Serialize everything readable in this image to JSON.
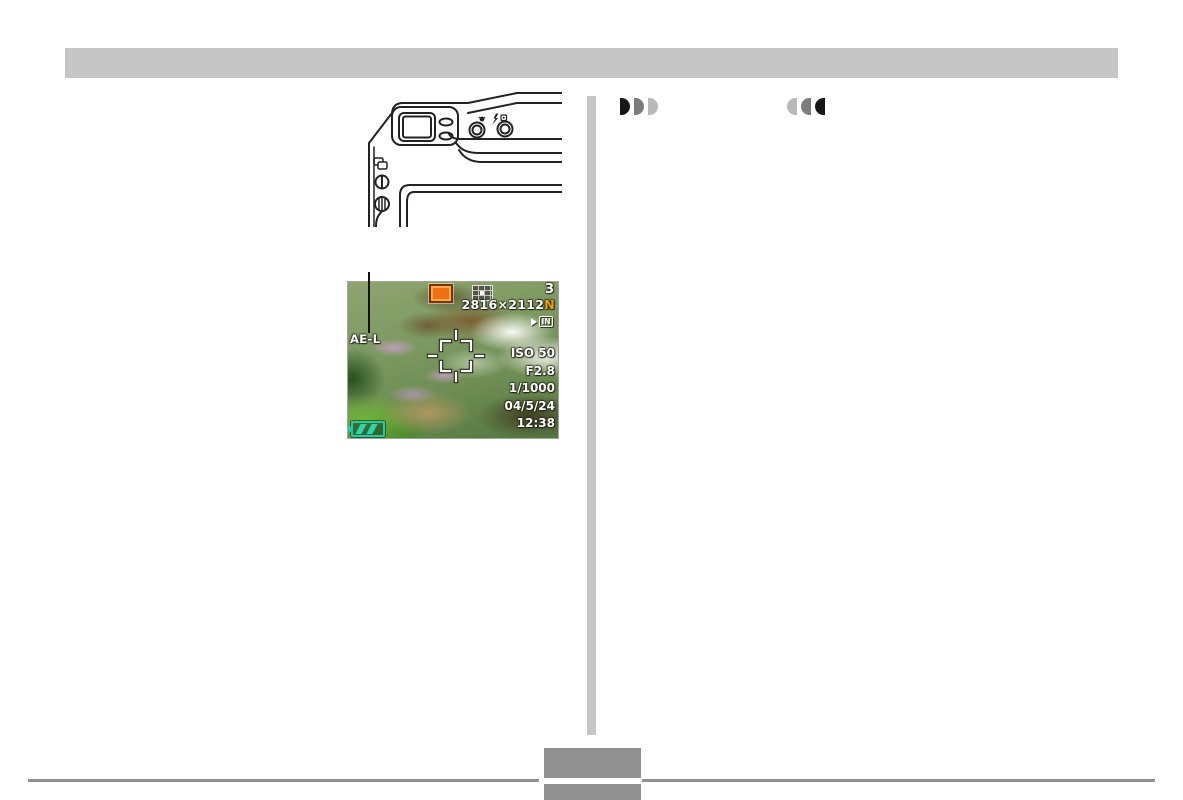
{
  "document": {
    "type": "camera manual page",
    "header_bar_color": "#c6c6c6",
    "divider_color": "#c6c6c6",
    "footer": {
      "rule_color": "#909090",
      "page_tab_color": "#909090"
    }
  },
  "icons": {
    "increase_indicator": "three half-discs pointing right, black to light gray",
    "decrease_indicator": "three half-discs pointing left, light gray to black",
    "recording_mode_icon": "orange snapshot square",
    "metering_icon": "multi-pattern metering grid",
    "memory_icon": "arrow into IN box",
    "battery_icon": "teal battery with two bars",
    "focus_frame_icon": "white corner brackets with center ticks"
  },
  "lcd": {
    "ae_lock_label": "AE-L",
    "remaining_shots": "3",
    "image_size": "2816×2112",
    "quality": "N",
    "memory": "IN",
    "iso": "ISO 50",
    "aperture": "F2.8",
    "shutter": "1/1000",
    "date": "04/5/24",
    "time": "12:38",
    "colors": {
      "quality_orange": "#f0a000",
      "rec_icon_orange": "#ee7010",
      "battery_teal": "#2bd0a8"
    }
  }
}
